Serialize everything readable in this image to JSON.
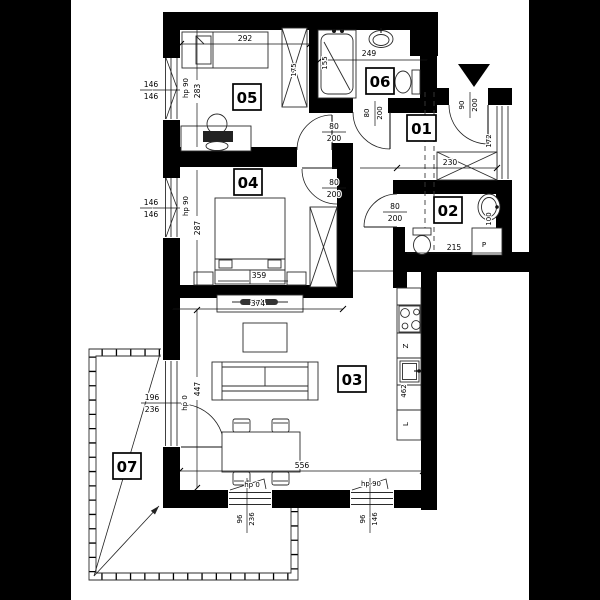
{
  "colors": {
    "background": "#000000",
    "paper": "#ffffff",
    "wall": "#000000",
    "line": "#222222"
  },
  "rooms": {
    "r01": "01",
    "r02": "02",
    "r03": "03",
    "r04": "04",
    "r05": "05",
    "r06": "06",
    "r07": "07"
  },
  "dims": {
    "room05_width": "292",
    "room05_height": "283",
    "wardrobe05": "175",
    "win_left_top_num": "146",
    "win_left_top_den": "146",
    "win_left_top_hp": "hp 90",
    "tub_length": "155",
    "bath06_width": "249",
    "door06_num": "80",
    "door06_den": "200",
    "door05_num": "80",
    "door05_den": "200",
    "door04_num": "80",
    "door04_den": "200",
    "door02_num": "80",
    "door02_den": "200",
    "entry_num": "90",
    "entry_den": "200",
    "hall_window": "172",
    "hall_width": "230",
    "bath02_width": "215",
    "sink02_width": "100",
    "win_left_mid_num": "146",
    "win_left_mid_den": "146",
    "win_left_mid_hp": "hp 90",
    "room04_height": "287",
    "bed04_width": "359",
    "room04_width": "374",
    "room03_height": "447",
    "room03_width": "556",
    "kitchen_length": "462",
    "balcony_num": "196",
    "balcony_den": "236",
    "balcony_hp": "hp 0",
    "win_bottom1_hp": "hp 0",
    "win_bottom1_num": "96",
    "win_bottom1_den": "236",
    "win_bottom2_hp": "hp 90",
    "win_bottom2_num": "96",
    "win_bottom2_den": "146"
  },
  "symbols": {
    "washer": "P",
    "dishwasher": "Z",
    "fridge": "L"
  }
}
